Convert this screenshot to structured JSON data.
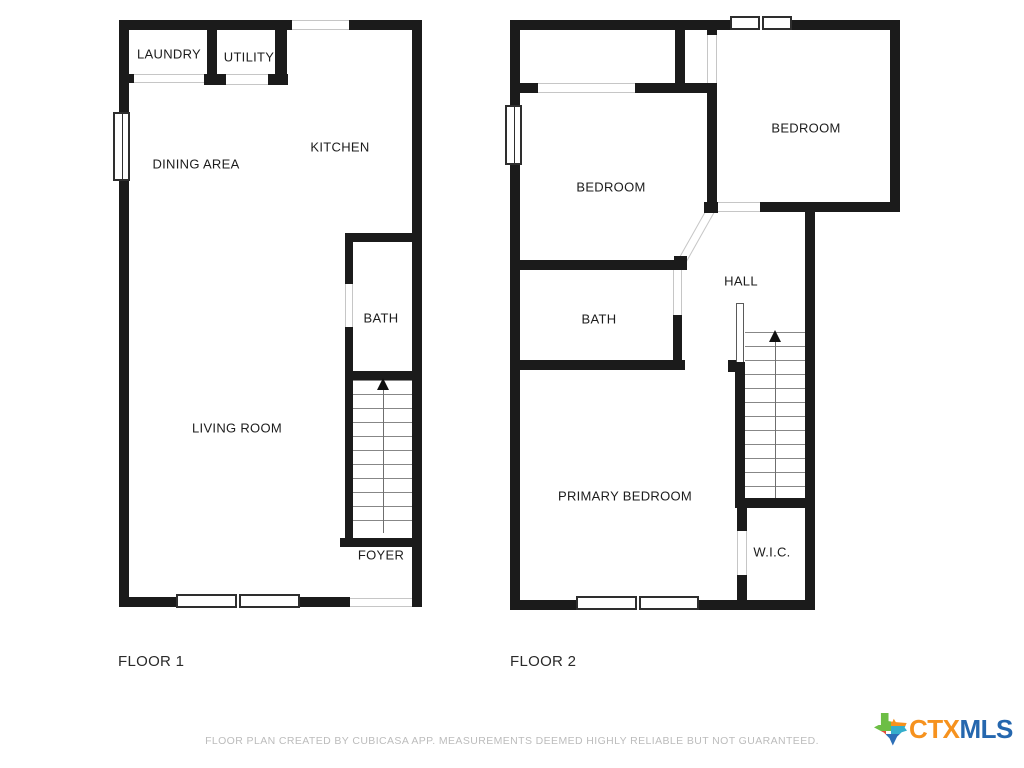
{
  "floors": [
    {
      "label": "FLOOR 1",
      "rooms": [
        {
          "label": "LAUNDRY"
        },
        {
          "label": "UTILITY"
        },
        {
          "label": "KITCHEN"
        },
        {
          "label": "DINING AREA"
        },
        {
          "label": "BATH"
        },
        {
          "label": "LIVING ROOM"
        },
        {
          "label": "FOYER"
        }
      ]
    },
    {
      "label": "FLOOR 2",
      "rooms": [
        {
          "label": "BEDROOM"
        },
        {
          "label": "BEDROOM"
        },
        {
          "label": "HALL"
        },
        {
          "label": "BATH"
        },
        {
          "label": "PRIMARY BEDROOM"
        },
        {
          "label": "W.I.C."
        }
      ]
    }
  ],
  "footer": {
    "disclaimer": "FLOOR PLAN CREATED BY CUBICASA APP. MEASUREMENTS DEEMED HIGHLY RELIABLE BUT NOT GUARANTEED."
  },
  "logo": {
    "ctx": "CTX",
    "mls": "MLS"
  },
  "colors": {
    "wall": "#1b1b1b",
    "disclaimer_gray": "#bcbcbc",
    "logo_orange": "#F6921E",
    "logo_blue": "#2567AE",
    "texas_green": "#6CBE45",
    "texas_orange": "#F6921E",
    "texas_red": "#E04E39",
    "texas_teal": "#35AECC",
    "texas_blue": "#2D6FB7"
  }
}
